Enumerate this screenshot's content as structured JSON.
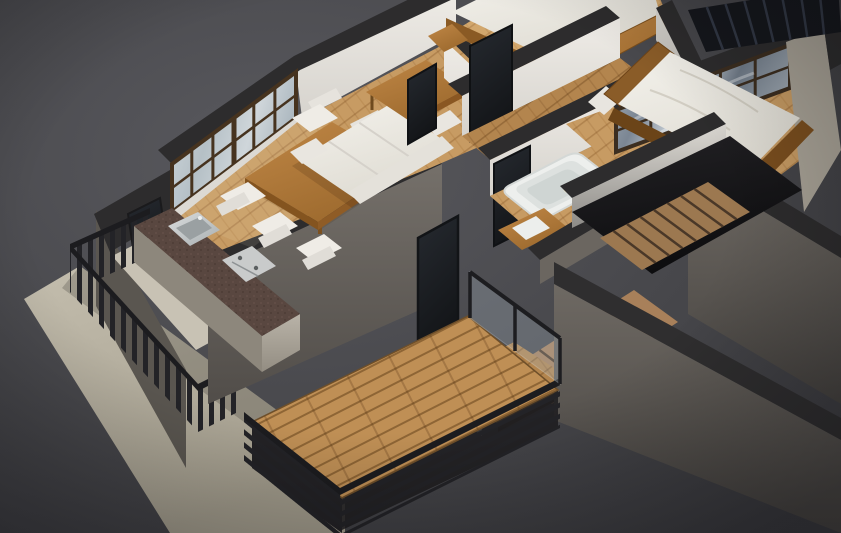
{
  "meta": {
    "content_type": "photorealistic-3d-render",
    "subject": "isometric-cutaway-apartment-floorplan",
    "has_text": false
  },
  "palette": {
    "bg": "#58585d",
    "bg_edge": "#3a3a3e",
    "wall_top": "#2d2c2d",
    "wall_int": "#e8e5e0",
    "wall_int_shade": "#cfccc6",
    "wall_ext": "#6e6963",
    "wall_ext_dark": "#57534f",
    "slab": "#b6b0a0",
    "floor_wood": "#c79b63",
    "floor_wood_dark": "#b3854e",
    "floor_wood_light": "#d2a76d",
    "deck_wood": "#bf8f55",
    "railing": "#232327",
    "rail_bar": "#1c1c1f",
    "window_frame": "#46331f",
    "glass_frost": "#c3ccd2",
    "glass_sky": "#8d98a4",
    "glass_dark": "#1f2126",
    "furniture_white": "#eceae4",
    "furniture_wood": "#b27a3a",
    "furniture_wood_dark": "#8a5a24",
    "counter": "#594740",
    "steel": "#c9cccd",
    "tub": "#edefed",
    "mattress": "#f2f0ea",
    "void": "#161517",
    "louvre": "#15171c"
  },
  "scene": {
    "rooms": [
      {
        "name": "living-dining-room"
      },
      {
        "name": "kitchen"
      },
      {
        "name": "small-bedroom"
      },
      {
        "name": "hallway"
      },
      {
        "name": "bathroom"
      },
      {
        "name": "master-bedroom"
      },
      {
        "name": "stairwell"
      },
      {
        "name": "left-balcony"
      },
      {
        "name": "main-balcony"
      },
      {
        "name": "ground-terrace-slab"
      }
    ],
    "objects": [
      {
        "name": "sofa"
      },
      {
        "name": "coffee-table"
      },
      {
        "name": "dining-table"
      },
      {
        "name": "dining-chairs",
        "count": 5
      },
      {
        "name": "kitchen-counter"
      },
      {
        "name": "kitchen-sink"
      },
      {
        "name": "cooktop"
      },
      {
        "name": "bathtub"
      },
      {
        "name": "vanity"
      },
      {
        "name": "double-bed-small"
      },
      {
        "name": "double-bed-master"
      },
      {
        "name": "staircase"
      },
      {
        "name": "slatted-railings"
      },
      {
        "name": "window-band-frosted"
      },
      {
        "name": "window-band-sky"
      },
      {
        "name": "sliding-glass-doors"
      },
      {
        "name": "roof-louvre"
      }
    ]
  }
}
